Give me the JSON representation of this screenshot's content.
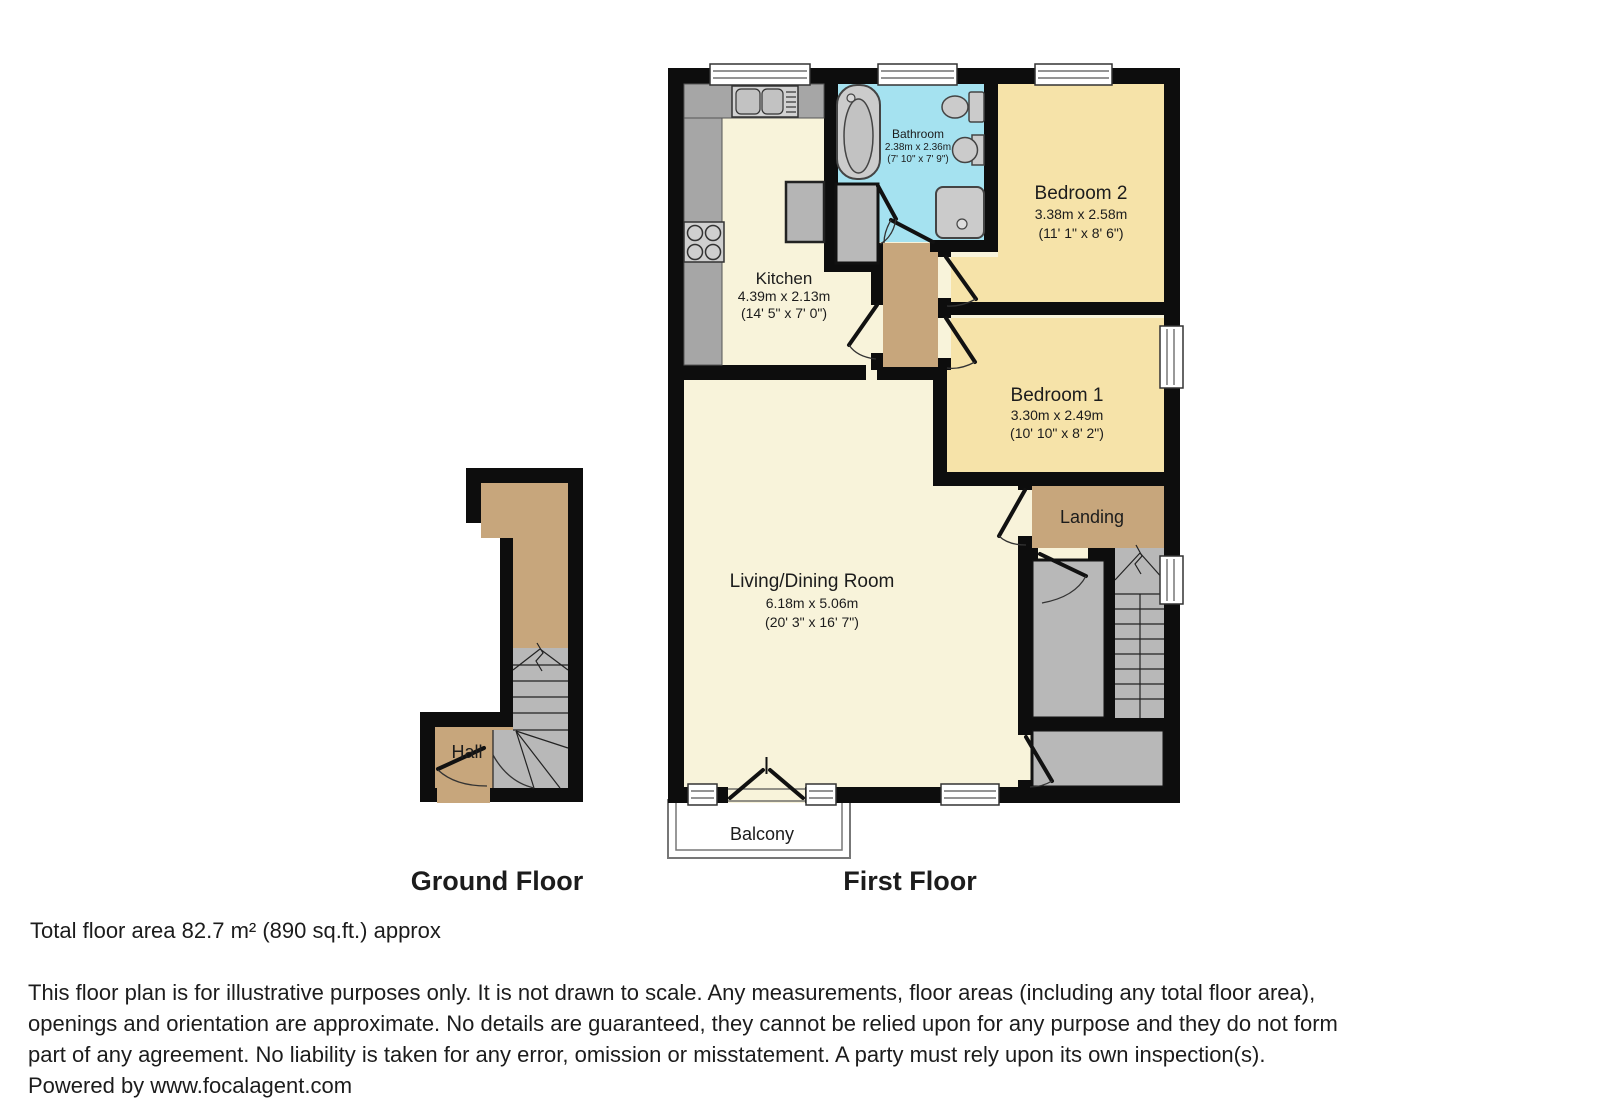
{
  "ground_floor": {
    "title": "Ground Floor",
    "rooms": {
      "hall": {
        "name": "Hall"
      }
    }
  },
  "first_floor": {
    "title": "First Floor",
    "rooms": {
      "kitchen": {
        "name": "Kitchen",
        "metric": "4.39m x 2.13m",
        "imperial": "(14' 5\" x 7' 0\")"
      },
      "bathroom": {
        "name": "Bathroom",
        "metric": "2.38m x 2.36m",
        "imperial": "(7' 10\" x 7' 9\")"
      },
      "bedroom2": {
        "name": "Bedroom 2",
        "metric": "3.38m x 2.58m",
        "imperial": "(11' 1\" x 8' 6\")"
      },
      "bedroom1": {
        "name": "Bedroom 1",
        "metric": "3.30m x 2.49m",
        "imperial": "(10' 10\" x 8' 2\")"
      },
      "living": {
        "name": "Living/Dining Room",
        "metric": "6.18m x 5.06m",
        "imperial": "(20' 3\" x 16' 7\")"
      },
      "landing": {
        "name": "Landing"
      },
      "balcony": {
        "name": "Balcony"
      }
    }
  },
  "footer": {
    "total_area": "Total floor area 82.7 m² (890 sq.ft.) approx",
    "disclaimer_lines": [
      "This floor plan is for illustrative purposes only. It is not drawn to scale. Any measurements, floor areas (including any total floor area),",
      "openings and orientation are approximate. No details are guaranteed, they cannot be relied upon for any purpose and they do not form",
      "part of any agreement. No liability is taken for any error, omission or misstatement. A party must rely upon its own inspection(s).",
      "Powered by www.focalagent.com"
    ]
  },
  "colors": {
    "wall": "#0d0d0d",
    "room_cream": "#f8f3da",
    "room_yellow": "#f6e3a9",
    "hallway_tan": "#c7a67c",
    "bathroom_blue": "#a5e2f0",
    "fixture_gray": "#c9c9c9",
    "counter_gray": "#a6a6a6",
    "stairs_gray": "#b8b8b8",
    "window_white": "#ffffff"
  }
}
